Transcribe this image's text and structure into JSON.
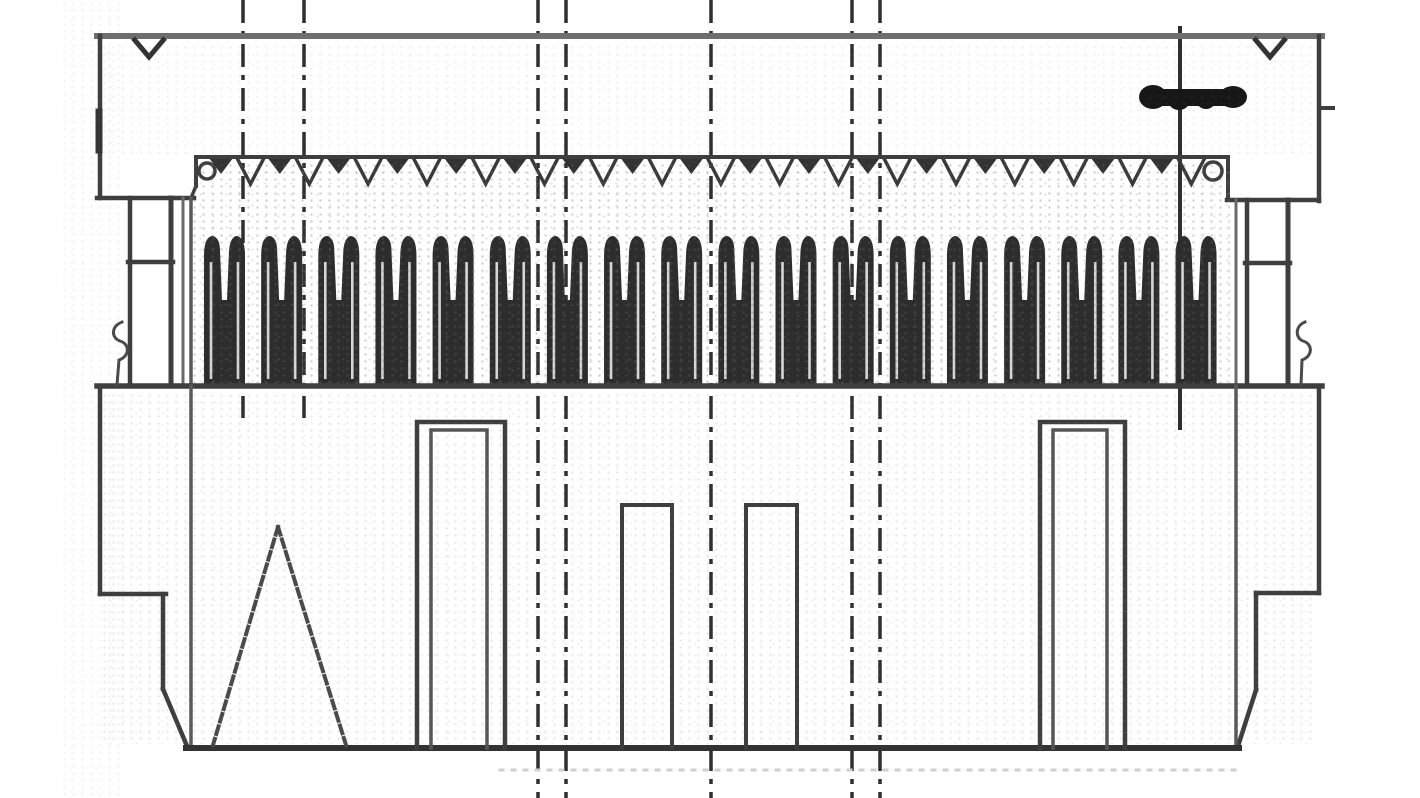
{
  "meta": {
    "description": "Engineering line drawing: cross-section of an IDC ribbon-cable socket connector (strain-relief cover, contact row, housing with polarizing slots)",
    "background": "#ffffff",
    "line_color": "#3e3e3e",
    "dark_color": "#262626",
    "soft_color": "#5a5a5a",
    "canvas": {
      "width": 1420,
      "height": 798
    }
  },
  "drawing": {
    "lines": [
      {
        "name": "cover-top-edge",
        "x1": 97,
        "y1": 36,
        "x2": 1322,
        "y2": 36,
        "w": 6,
        "c": "#6e6e6e"
      },
      {
        "name": "left-ear-outer-edge",
        "x1": 100,
        "y1": 36,
        "x2": 100,
        "y2": 198,
        "w": 4.5
      },
      {
        "name": "left-ear-edge-smudge",
        "x1": 99,
        "y1": 112,
        "x2": 99,
        "y2": 150,
        "w": 7,
        "c": "#343434"
      },
      {
        "name": "left-ear-bottom-edge",
        "x1": 97,
        "y1": 198,
        "x2": 194,
        "y2": 198,
        "w": 4.5
      },
      {
        "name": "right-ear-outer-edge",
        "x1": 1319,
        "y1": 36,
        "x2": 1319,
        "y2": 201,
        "w": 4.5
      },
      {
        "name": "right-ear-bottom-edge",
        "x1": 1227,
        "y1": 200,
        "x2": 1319,
        "y2": 200,
        "w": 4.5
      },
      {
        "name": "right-ear-side-tick",
        "x1": 1319,
        "y1": 108,
        "x2": 1333,
        "y2": 108,
        "w": 4
      },
      {
        "name": "left-latch-post-outer",
        "x1": 130,
        "y1": 198,
        "x2": 130,
        "y2": 385,
        "w": 4.5
      },
      {
        "name": "left-latch-post-inner",
        "x1": 171,
        "y1": 198,
        "x2": 171,
        "y2": 385,
        "w": 5
      },
      {
        "name": "left-latch-skirt",
        "x1": 183,
        "y1": 198,
        "x2": 183,
        "y2": 385,
        "w": 3,
        "c": "#6a6a6a"
      },
      {
        "name": "left-latch-tick",
        "x1": 128,
        "y1": 262,
        "x2": 173,
        "y2": 262,
        "w": 4.5
      },
      {
        "name": "right-latch-post-outer",
        "x1": 1288,
        "y1": 200,
        "x2": 1288,
        "y2": 385,
        "w": 5
      },
      {
        "name": "right-latch-post-inner",
        "x1": 1247,
        "y1": 200,
        "x2": 1247,
        "y2": 385,
        "w": 4.5
      },
      {
        "name": "right-latch-skirt",
        "x1": 1236,
        "y1": 200,
        "x2": 1236,
        "y2": 385,
        "w": 3,
        "c": "#6a6a6a"
      },
      {
        "name": "right-latch-tick",
        "x1": 1245,
        "y1": 263,
        "x2": 1290,
        "y2": 263,
        "w": 4.5
      },
      {
        "name": "cover-cable-edge",
        "x1": 196,
        "y1": 157,
        "x2": 1228,
        "y2": 157,
        "w": 4
      },
      {
        "name": "cover-left-step",
        "x1": 196,
        "y1": 157,
        "x2": 196,
        "y2": 186,
        "w": 4
      },
      {
        "name": "cover-left-step-diagonal",
        "x1": 196,
        "y1": 186,
        "x2": 191,
        "y2": 198,
        "w": 3.5
      },
      {
        "name": "cover-right-step",
        "x1": 1228,
        "y1": 160,
        "x2": 1228,
        "y2": 200,
        "w": 4
      },
      {
        "name": "left-wall-upper",
        "x1": 191,
        "y1": 198,
        "x2": 191,
        "y2": 386,
        "w": 3.5,
        "c": "#5a5a5a"
      },
      {
        "name": "housing-top-edge",
        "x1": 97,
        "y1": 386,
        "x2": 1322,
        "y2": 386,
        "w": 5.5
      },
      {
        "name": "left-flange-outer-edge",
        "x1": 100,
        "y1": 386,
        "x2": 100,
        "y2": 594,
        "w": 4.5
      },
      {
        "name": "left-flange-bottom-edge",
        "x1": 100,
        "y1": 594,
        "x2": 166,
        "y2": 594,
        "w": 4.5
      },
      {
        "name": "left-lower-wall",
        "x1": 163,
        "y1": 594,
        "x2": 163,
        "y2": 689,
        "w": 4.5
      },
      {
        "name": "left-bottom-chamfer",
        "x1": 163,
        "y1": 689,
        "x2": 187,
        "y2": 746,
        "w": 4.5
      },
      {
        "name": "left-inner-wall",
        "x1": 191,
        "y1": 386,
        "x2": 191,
        "y2": 748,
        "w": 3.5,
        "c": "#5a5a5a"
      },
      {
        "name": "right-flange-outer-edge",
        "x1": 1319,
        "y1": 389,
        "x2": 1319,
        "y2": 593,
        "w": 4.5
      },
      {
        "name": "right-flange-bottom-edge",
        "x1": 1256,
        "y1": 593,
        "x2": 1319,
        "y2": 593,
        "w": 4.5
      },
      {
        "name": "right-lower-wall",
        "x1": 1256,
        "y1": 593,
        "x2": 1256,
        "y2": 690,
        "w": 4.5
      },
      {
        "name": "right-bottom-chamfer",
        "x1": 1256,
        "y1": 690,
        "x2": 1238,
        "y2": 746,
        "w": 4.5
      },
      {
        "name": "right-inner-wall",
        "x1": 1236,
        "y1": 386,
        "x2": 1236,
        "y2": 748,
        "w": 3.5,
        "c": "#5a5a5a"
      },
      {
        "name": "housing-bottom-edge",
        "x1": 186,
        "y1": 748,
        "x2": 1239,
        "y2": 748,
        "w": 6,
        "c": "#333333"
      },
      {
        "name": "scan-artifact-dotted-line",
        "x1": 500,
        "y1": 770,
        "x2": 1240,
        "y2": 770,
        "w": 3,
        "c": "#cfcfcf",
        "dash": "3 9"
      }
    ],
    "vees": [
      {
        "name": "left-ear-notch",
        "points": "133,38 149,57 165,38",
        "w": 5
      },
      {
        "name": "right-ear-notch",
        "points": "1254,38 1270,57 1286,38",
        "w": 5
      }
    ],
    "paths": [
      {
        "name": "keying-slot-left-outer",
        "d": "M 417,748 L 417,422 L 505,422 L 505,748",
        "w": 4.5
      },
      {
        "name": "keying-slot-left-inner",
        "d": "M 431,748 L 431,430 L 487,430 L 487,748",
        "w": 3.5,
        "c": "#555555"
      },
      {
        "name": "keying-slot-right-outer",
        "d": "M 1040,748 L 1040,422 L 1125,422 L 1125,748",
        "w": 4.5
      },
      {
        "name": "keying-slot-right-inner",
        "d": "M 1053,748 L 1053,430 L 1107,430 L 1107,748",
        "w": 3.5,
        "c": "#555555"
      },
      {
        "name": "center-slot-left",
        "d": "M 622,748 L 622,505 L 672,505 L 672,748",
        "w": 4
      },
      {
        "name": "center-slot-right",
        "d": "M 746,748 L 746,505 L 797,505 L 797,748",
        "w": 4
      },
      {
        "name": "polarity-triangle-left-leg",
        "d": "M 278,527 L 213,745",
        "w": 4,
        "c": "#4a4a4a",
        "dash": "8 5"
      },
      {
        "name": "polarity-triangle-right-leg",
        "d": "M 278,527 L 346,745",
        "w": 4,
        "c": "#4a4a4a",
        "dash": "8 5"
      },
      {
        "name": "left-spring-squiggle",
        "d": "M 122,322 C 111,326 111,338 120,341 C 130,344 130,356 119,360 L 117,385",
        "w": 3,
        "c": "#4a4a4a"
      },
      {
        "name": "right-spring-squiggle",
        "d": "M 1305,322 C 1295,326 1295,338 1303,341 C 1313,344 1313,356 1302,360 L 1301,385",
        "w": 3,
        "c": "#4a4a4a"
      }
    ],
    "circles": [
      {
        "name": "cable-end-loop-left",
        "cx": 207,
        "cy": 171,
        "r": 8,
        "w": 3.5
      },
      {
        "name": "cable-end-loop-right",
        "cx": 1213,
        "cy": 171,
        "r": 9,
        "w": 3.5
      }
    ],
    "centerlines": [
      {
        "name": "centerline-a",
        "x": 243,
        "y1": 0,
        "y2": 418,
        "dash": "23 8 5 8"
      },
      {
        "name": "centerline-b",
        "x": 304,
        "y1": 0,
        "y2": 418,
        "dash": "23 8 5 8"
      },
      {
        "name": "centerline-c",
        "x": 538,
        "y1": 0,
        "y2": 798,
        "dash": "23 8 5 8"
      },
      {
        "name": "centerline-d",
        "x": 566,
        "y1": 0,
        "y2": 798,
        "dash": "23 8 5 8"
      },
      {
        "name": "centerline-center",
        "x": 711,
        "y1": 0,
        "y2": 798,
        "dash": "23 8 5 8"
      },
      {
        "name": "centerline-e",
        "x": 852,
        "y1": 0,
        "y2": 798,
        "dash": "23 8 5 8"
      },
      {
        "name": "centerline-f",
        "x": 880,
        "y1": 0,
        "y2": 798,
        "dash": "23 8 5 8"
      },
      {
        "name": "centerline-right-solid",
        "x": 1180,
        "y1": 26,
        "y2": 430,
        "dash": ""
      }
    ],
    "ink_mark": {
      "name": "ink-blob-mark",
      "ellipses": [
        {
          "cx": 1153,
          "cy": 97,
          "rx": 14,
          "ry": 12
        },
        {
          "cx": 1179,
          "cy": 100,
          "rx": 11,
          "ry": 10
        },
        {
          "cx": 1206,
          "cy": 99,
          "rx": 10,
          "ry": 10
        },
        {
          "cx": 1233,
          "cy": 97,
          "rx": 14,
          "ry": 11
        }
      ],
      "bar": {
        "x": 1147,
        "y": 89,
        "w": 94,
        "h": 17
      },
      "color": "#171717"
    },
    "serration": {
      "name": "cable-serration",
      "count": 17,
      "x0": 206,
      "pitch": 58.8,
      "y": 158,
      "small_tri": {
        "o1": 3,
        "apex": 15,
        "o2": 27,
        "depth": 16,
        "fill": "#333333"
      },
      "open_v": {
        "o1": 31,
        "apex": 44.5,
        "o2": 58,
        "depth": 26,
        "w": 3.5,
        "c": "#3a3a3a"
      }
    },
    "contacts": {
      "name": "idc-contact-row",
      "count": 18,
      "x0": 204,
      "pitch": 57.15,
      "width": 41,
      "top_y": 236,
      "base_y": 385,
      "notch_y": 300,
      "fill": "#2d2d2d",
      "slit_color": "#f4f4f4"
    }
  }
}
